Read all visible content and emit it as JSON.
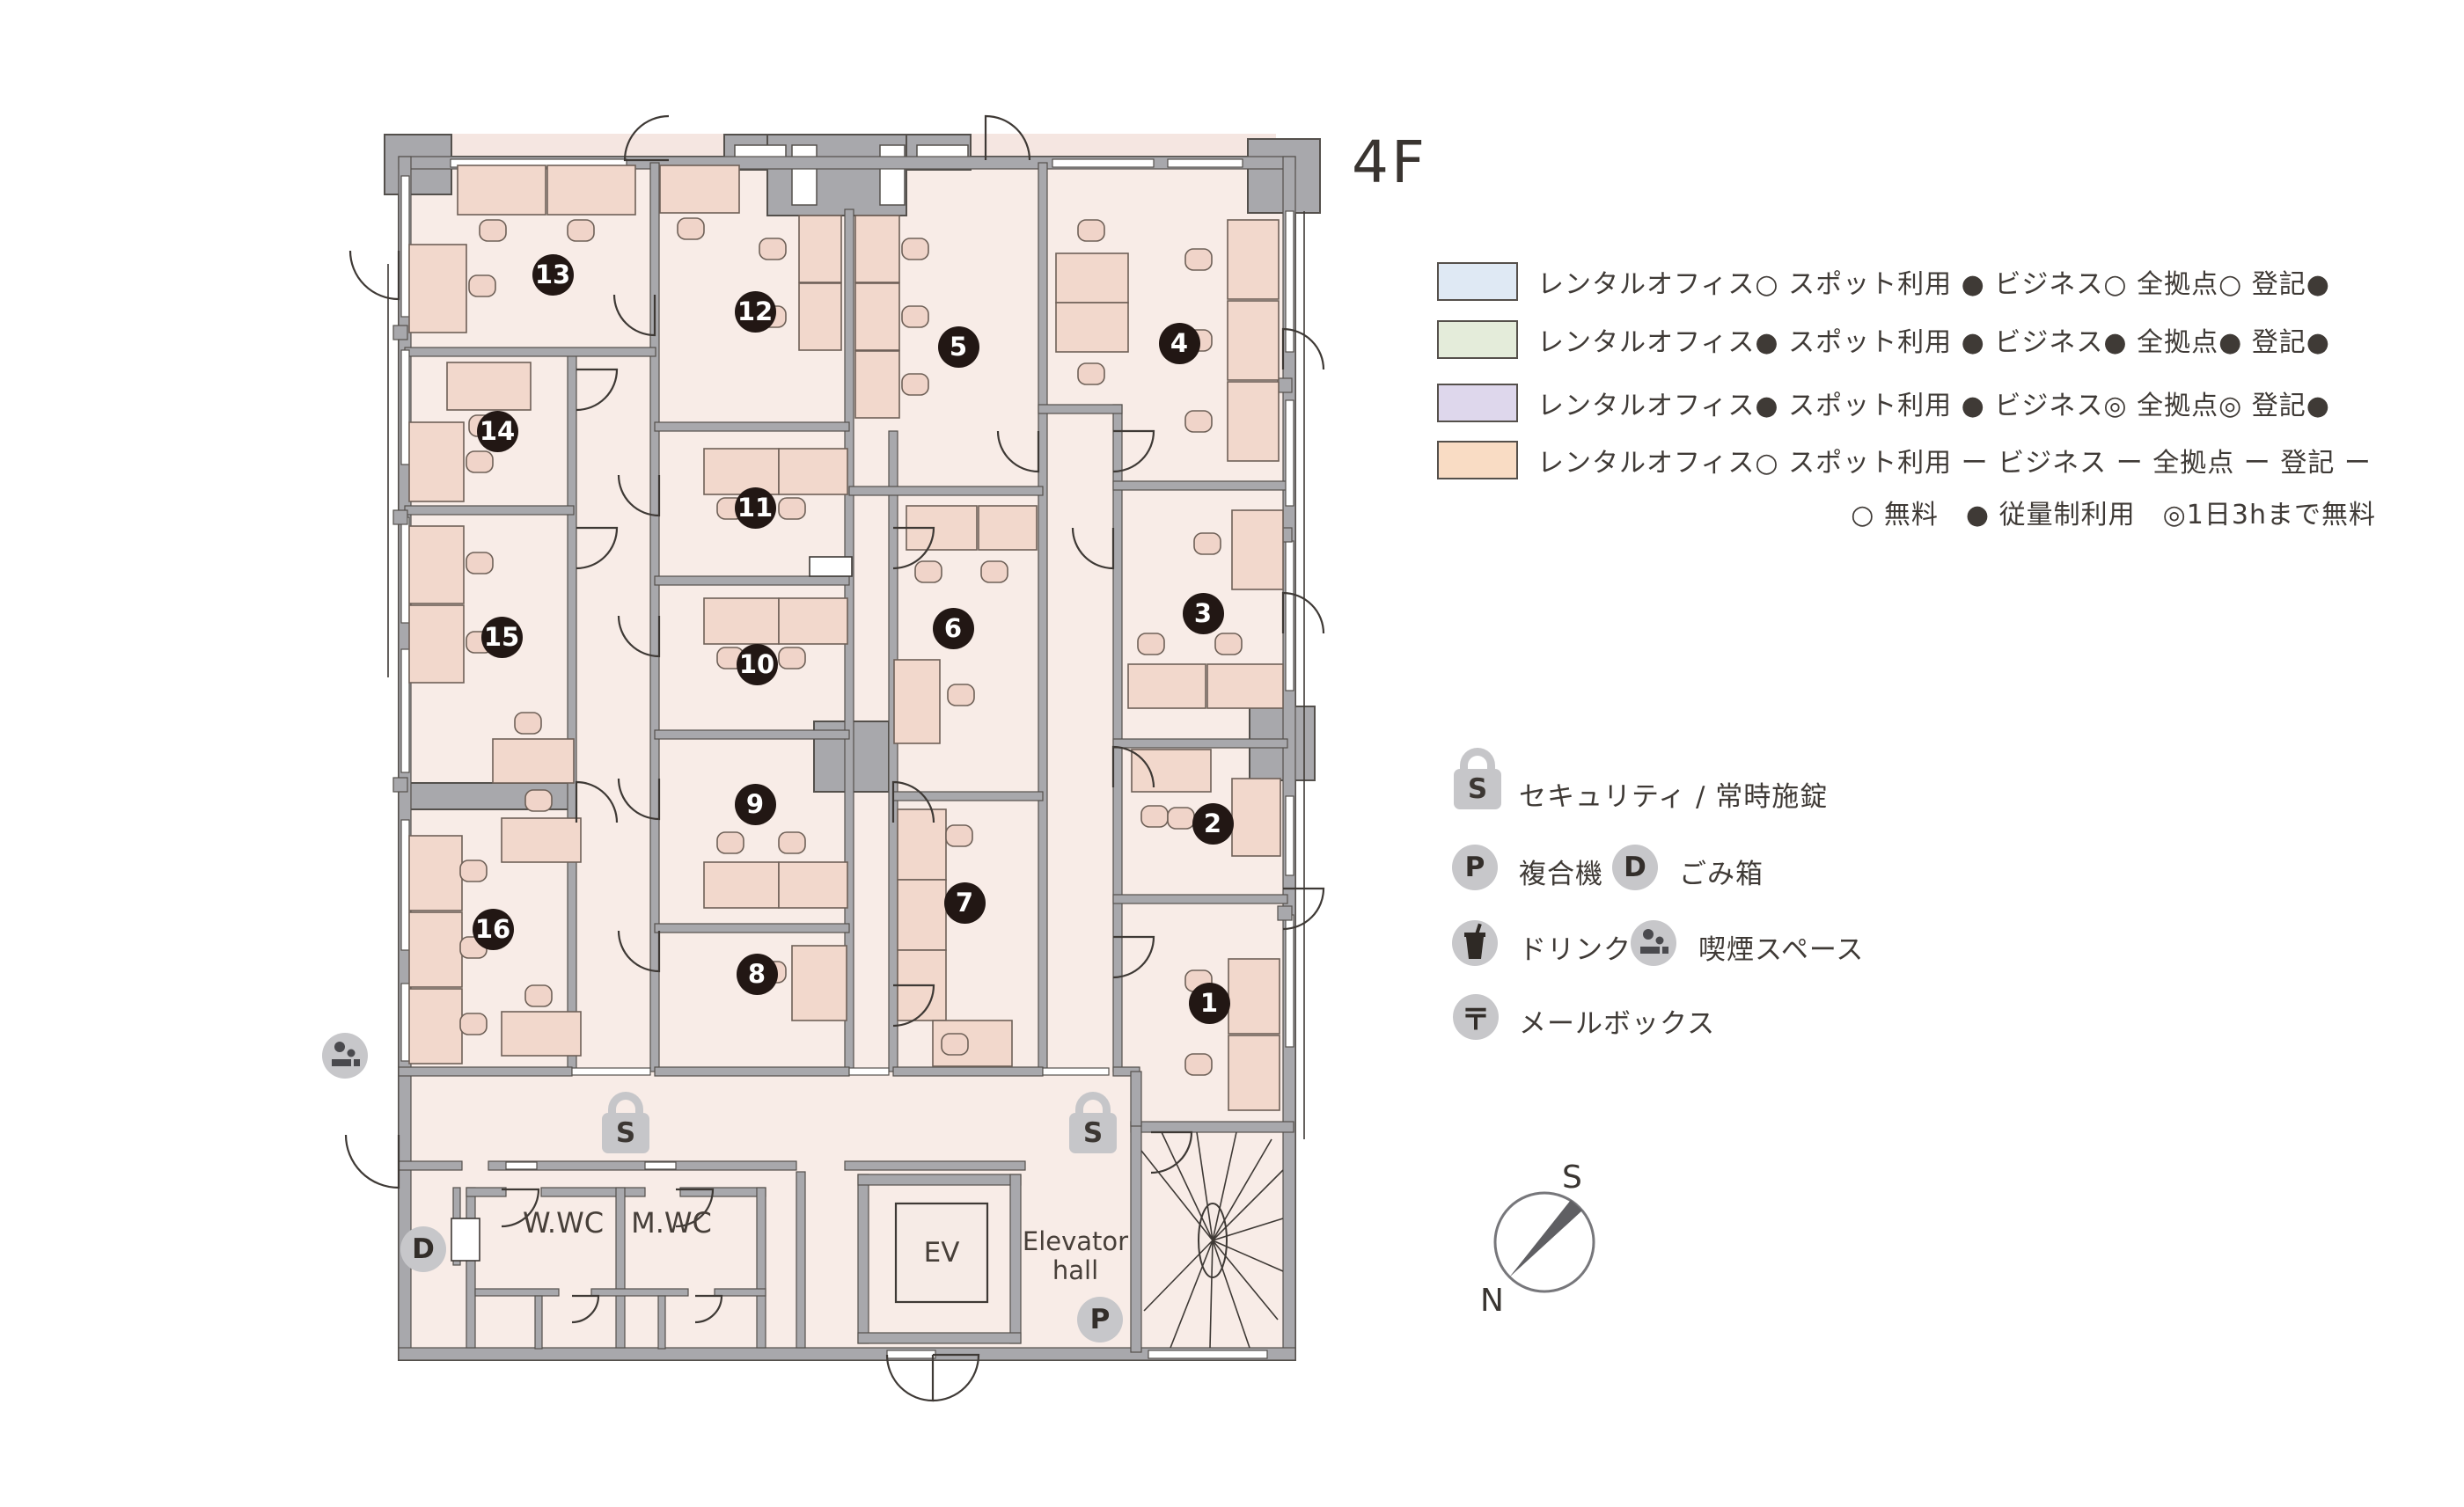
{
  "title": "4F",
  "legend": {
    "rows": [
      {
        "color": "#dfe9f4",
        "text": "レンタルオフィス○ スポット利用 ● ビジネス○ 全拠点○ 登記●"
      },
      {
        "color": "#e4ecda",
        "text": "レンタルオフィス● スポット利用 ● ビジネス● 全拠点● 登記●"
      },
      {
        "color": "#ded7ec",
        "text": "レンタルオフィス● スポット利用 ● ビジネス◎ 全拠点◎ 登記●"
      },
      {
        "color": "#f9dcc4",
        "text": "レンタルオフィス○ スポット利用 ー ビジネス ー 全拠点 ー 登記 ー"
      }
    ],
    "note": "○ 無料　● 従量制利用　◎1日3hまで無料"
  },
  "icon_legend": {
    "security": {
      "symbol": "S",
      "label": "セキュリティ / 常時施錠"
    },
    "copier": {
      "symbol": "P",
      "label": "複合機"
    },
    "trash": {
      "symbol": "D",
      "label": "ごみ箱"
    },
    "drink": {
      "label": "ドリンク"
    },
    "smoking": {
      "label": "喫煙スペース"
    },
    "mailbox": {
      "symbol": "〒",
      "label": "メールボックス"
    }
  },
  "floorplan": {
    "rooms": [
      "1",
      "2",
      "3",
      "4",
      "5",
      "6",
      "7",
      "8",
      "9",
      "10",
      "11",
      "12",
      "13",
      "14",
      "15",
      "16"
    ],
    "labels": {
      "womens_wc": "W.WC",
      "mens_wc": "M.WC",
      "elevator": "EV",
      "elevator_hall": "Elevator hall"
    },
    "markers": {
      "security": "S",
      "copier": "P",
      "trash": "D"
    }
  },
  "compass": {
    "north": "N",
    "south": "S"
  },
  "colors": {
    "room_fill": "#f8ece7",
    "desk_fill": "#f2d8cc",
    "wall_gray": "#a8a8ac",
    "badge": "#221714"
  }
}
